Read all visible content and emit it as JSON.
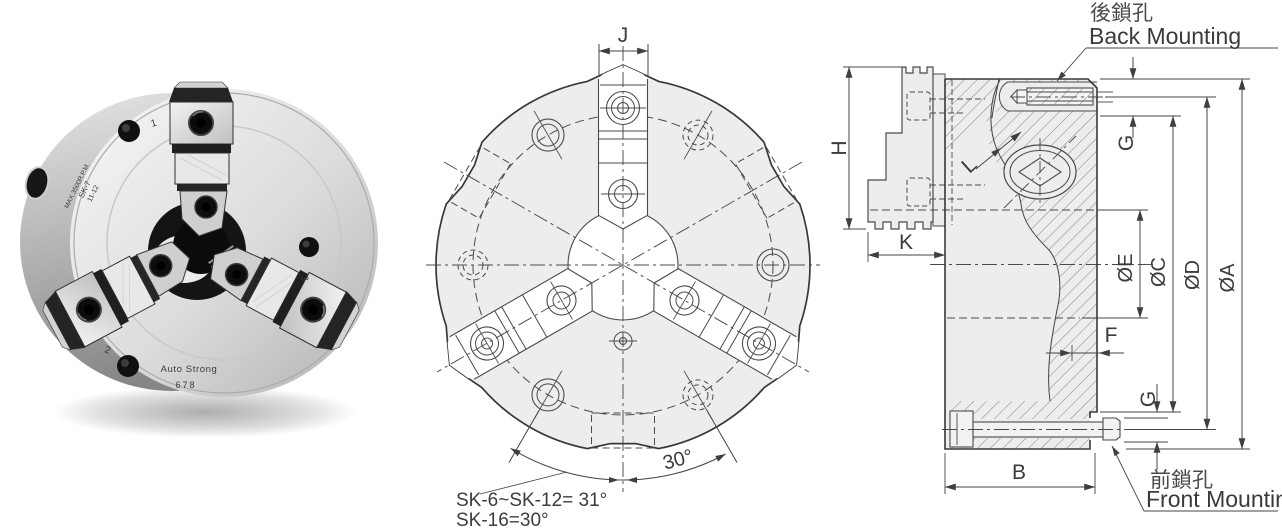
{
  "figure": {
    "description_visible_text_only": true
  },
  "photo": {
    "brand": "Auto Strong",
    "serial": "678",
    "stamp": [
      "MAX.3500R.P.M.",
      "SK-7",
      "11-12"
    ],
    "jaw_numbers": [
      "1",
      "2",
      "3"
    ]
  },
  "front_view": {
    "dim_j": "J",
    "angle_label": "30°",
    "note1": "SK-6~SK-12= 31°",
    "note2": "SK-16=30°"
  },
  "section_view": {
    "back_mounting": {
      "cjk": "後鎖孔",
      "en": "Back Mounting"
    },
    "front_mounting": {
      "cjk": "前鎖孔",
      "en": "Front Mounting"
    },
    "dims": {
      "H": "H",
      "K": "K",
      "L": "L",
      "G_top": "G",
      "G_bottom": "G",
      "F": "F",
      "B": "B",
      "E": "ØE",
      "C": "ØC",
      "D": "ØD",
      "A": "ØA"
    }
  },
  "colors": {
    "background": "#ffffff",
    "drawing_line": "#4a4a4a",
    "drawing_outline": "#383838",
    "drawing_fill": "#ededed",
    "text": "#3b3b3b",
    "photo_metal_light": "#f6f6f6",
    "photo_metal_dark": "#8f8f8f"
  }
}
